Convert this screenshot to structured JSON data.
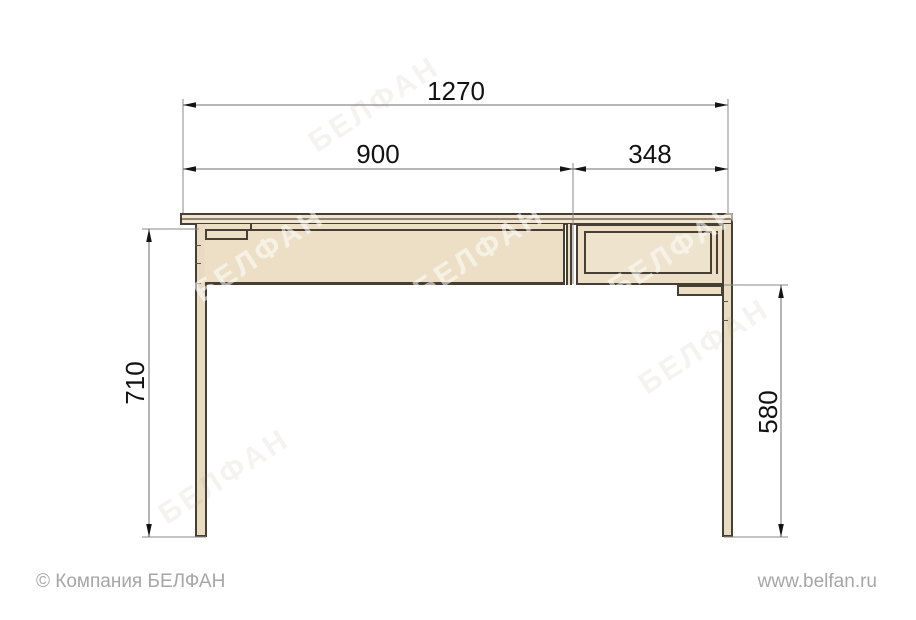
{
  "drawing": {
    "type": "furniture-dimension-diagram",
    "subject": "desk front elevation with drawer unit",
    "dimensions": {
      "overall_width": "1270",
      "desk_section_width": "900",
      "drawer_section_width": "348",
      "leg_height": "710",
      "under_drawer_height": "580"
    },
    "colors": {
      "wood_fill": "#ecdfc6",
      "outline": "#473f33",
      "dimension_line": "#6e6e6e",
      "dimension_text": "#121212"
    }
  },
  "watermark": {
    "text": "БЕЛФАН"
  },
  "footer": {
    "copyright": "© Компания БЕЛФАН",
    "website": "www.belfan.ru"
  }
}
